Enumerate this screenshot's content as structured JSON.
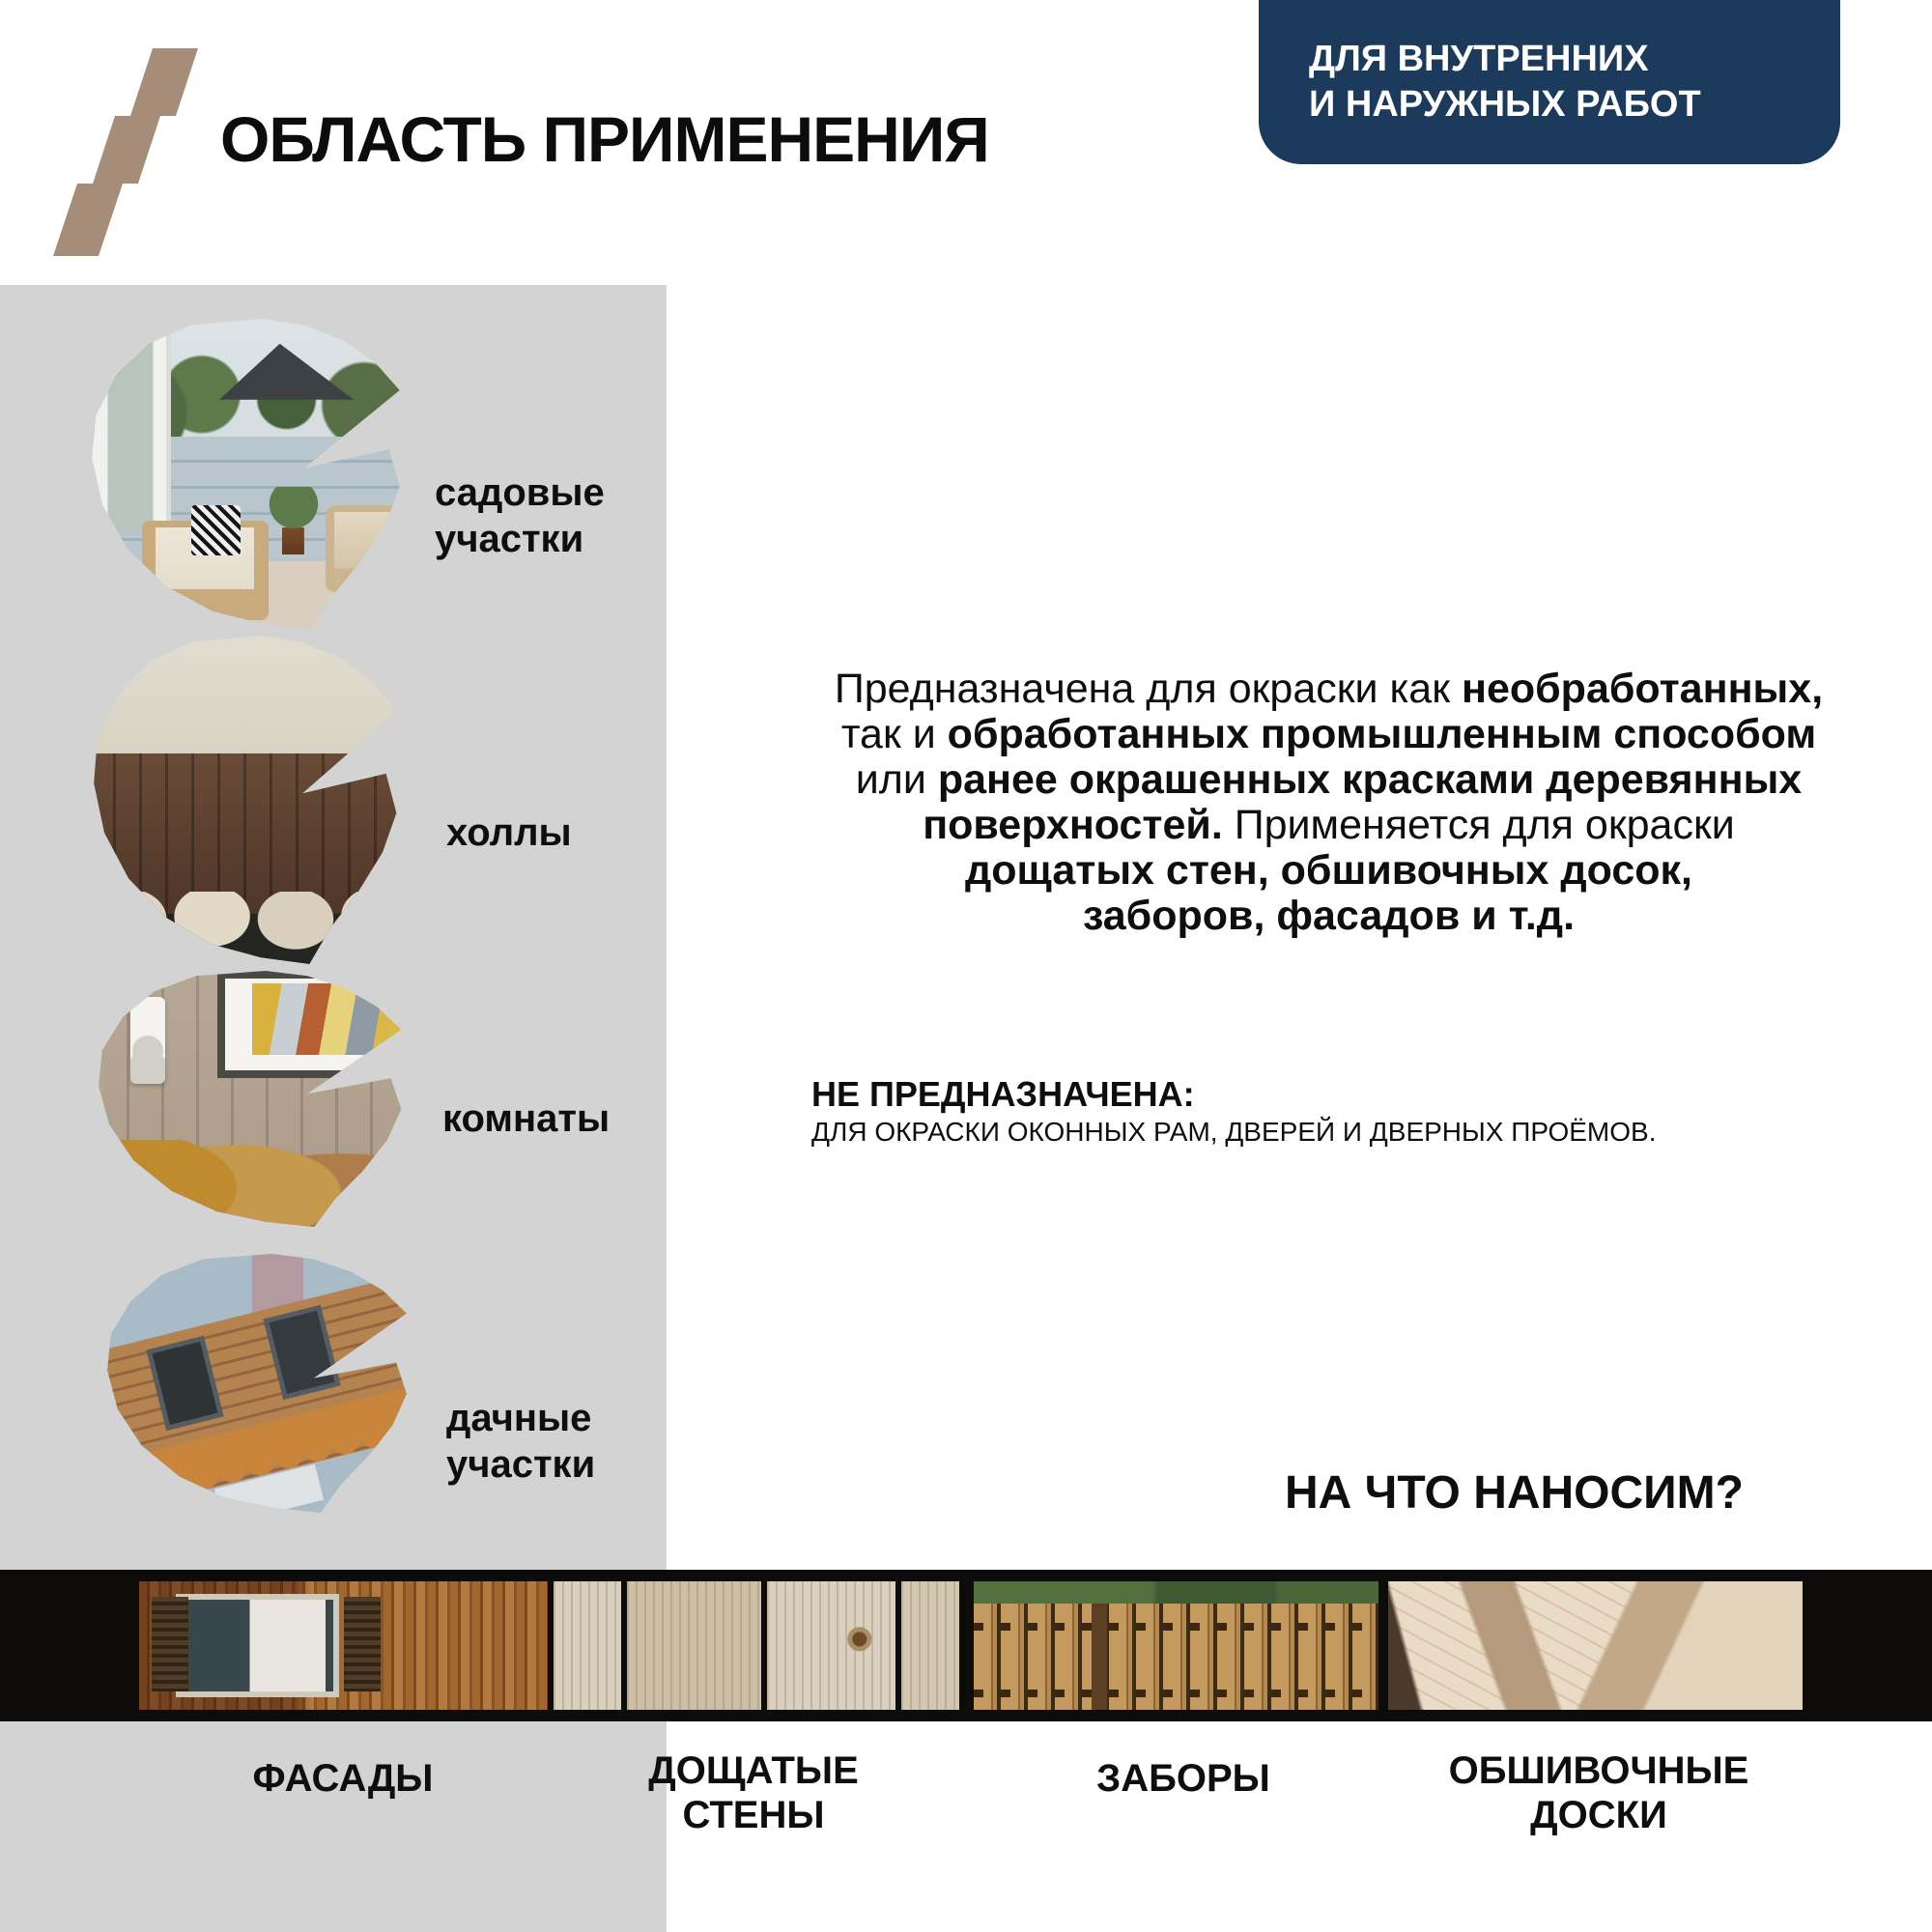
{
  "colors": {
    "accent_navy": "#1b3a5c",
    "bolt_tan": "#a58d79",
    "panel_gray": "#d3d3d3",
    "strip_black": "#0d0c0a",
    "text_black": "#0e0e0e"
  },
  "header": {
    "logo_icon": "lightning-bolt-icon",
    "title": "ОБЛАСТЬ ПРИМЕНЕНИЯ",
    "badge": {
      "line1": "ДЛЯ ВНУТРЕННИХ",
      "line2": "И НАРУЖНЫХ РАБОТ"
    }
  },
  "applications": [
    {
      "photo": "garden-patio-photo",
      "label_line1": "садовые",
      "label_line2": "участки"
    },
    {
      "photo": "hall-interior-photo",
      "label_line1": "холлы",
      "label_line2": ""
    },
    {
      "photo": "room-interior-photo",
      "label_line1": "комнаты",
      "label_line2": ""
    },
    {
      "photo": "country-house-photo",
      "label_line1": "дачные",
      "label_line2": "участки"
    }
  ],
  "intro": {
    "l1_regular": "Предназначена для окраски как ",
    "l1_bold": "необработанных",
    "l1_tail": ",",
    "l2_regular": "так и ",
    "l2_bold": "обработанных промышленным способом",
    "l3_regular": "или ",
    "l3_bold": "ранее окрашенных красками деревянных",
    "l4_bold": "поверхностей.",
    "l4_regular": " Применяется для окраски",
    "l5_bold": "дощатых стен, обшивочных досок,",
    "l6_bold": "заборов, фасадов и т.д."
  },
  "not_intended": {
    "title": "НЕ ПРЕДНАЗНАЧЕНА:",
    "text": "ДЛЯ ОКРАСКИ ОКОННЫХ РАМ, ДВЕРЕЙ И ДВЕРНЫХ ПРОЁМОВ."
  },
  "surfaces_heading": "НА ЧТО НАНОСИМ?",
  "surfaces": [
    {
      "photo": "facade-wood-wall-photo",
      "label_line1": "ФАСАДЫ",
      "label_line2": ""
    },
    {
      "photo": "plank-boards-photo",
      "label_line1": "ДОЩАТЫЕ",
      "label_line2": "СТЕНЫ"
    },
    {
      "photo": "wooden-fence-photo",
      "label_line1": "ЗАБОРЫ",
      "label_line2": ""
    },
    {
      "photo": "cladding-boards-photo",
      "label_line1": "ОБШИВОЧНЫЕ",
      "label_line2": "ДОСКИ"
    }
  ]
}
